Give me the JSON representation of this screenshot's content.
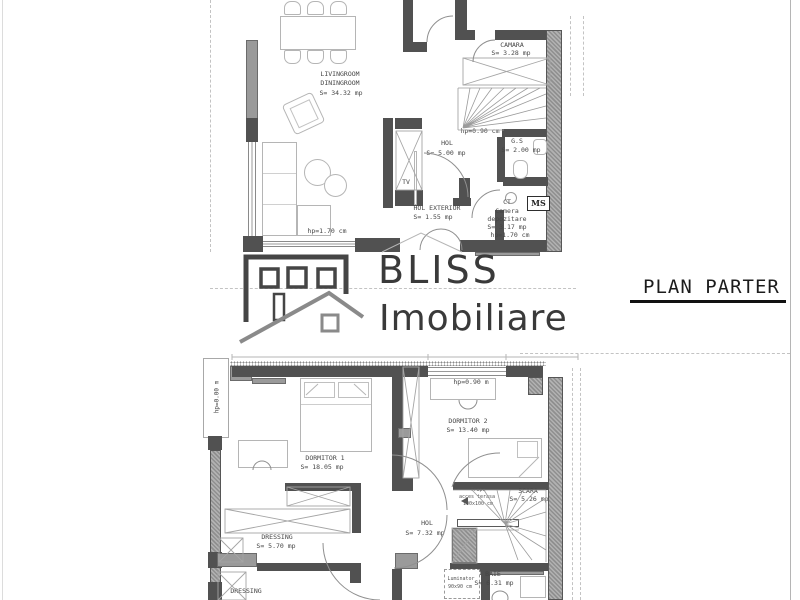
{
  "brand": {
    "line1": "BLISS",
    "line2": "Imobiliare"
  },
  "plan_title": "PLAN PARTER",
  "parter": {
    "living": {
      "l1": "LIVINGROOM",
      "l2": "DININGROOM",
      "area": "S= 34.32 mp"
    },
    "camara": {
      "label": "CAMARA",
      "area": "S= 3.28 mp"
    },
    "stairs_note": "hp=0.90 cm",
    "hol": {
      "label": "HOL",
      "area": "S= 5.00 mp"
    },
    "gs": {
      "label": "G.S",
      "area": "S= 2.00 mp"
    },
    "tv": "TV",
    "hol_exterior": {
      "label": "HOL EXTERIOR",
      "area": "S= 1.55 mp"
    },
    "ct": "CT",
    "storage": {
      "l1": "Camera",
      "l2": "depozitare",
      "area": "S= 3.17 mp",
      "note": "hp=1.70 cm"
    },
    "ms": "MS",
    "window_note": "hp=1.70 cm"
  },
  "etaj": {
    "balcony_note": "hp=0.00 m",
    "dorm1": {
      "label": "DORMITOR 1",
      "area": "S= 18.05 mp"
    },
    "dorm2": {
      "label": "DORMITOR 2",
      "area": "S= 13.40 mp",
      "note": "hp=0.90 m"
    },
    "hol": {
      "label": "HOL",
      "area": "S= 7.32 mp"
    },
    "dressing1": {
      "label": "DRESSING",
      "area": "S= 5.70 mp"
    },
    "dressing2": {
      "label": "DRESSING"
    },
    "scara": {
      "label": "SCARA",
      "area": "S= 5.26 mp"
    },
    "trapa": {
      "l1": "Trapa",
      "l2": "acces terasa",
      "l3": "100x100 cm"
    },
    "baie": {
      "label": "BAIE",
      "area": "S= 6.31 mp"
    },
    "luminator": {
      "l1": "Luminator",
      "l2": "90x90 cm"
    }
  }
}
